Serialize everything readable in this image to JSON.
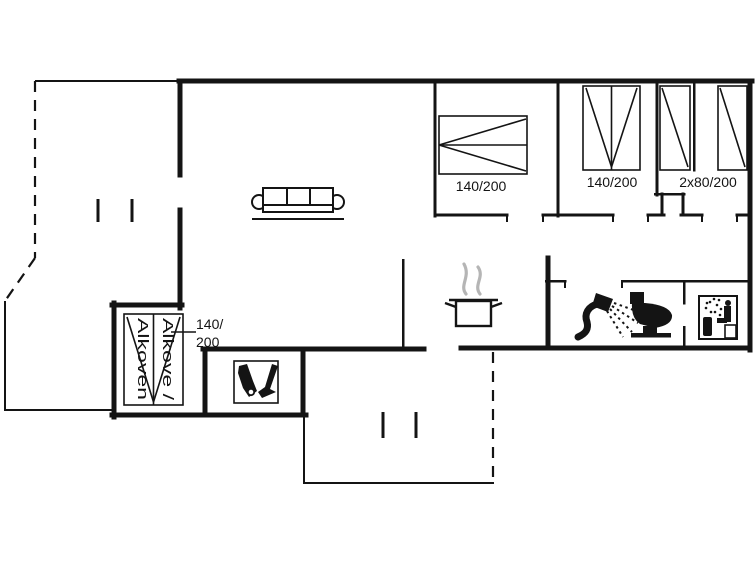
{
  "floorplan": {
    "colors": {
      "background": "#ffffff",
      "line": "#141414",
      "steam": "#b5b5b5"
    },
    "labels": {
      "bedroom1_bed_size": "140/200",
      "bedroom2_bed_size": "140/200",
      "bedroom3_bed_size": "2x80/200",
      "alcove_size_line1": "140/",
      "alcove_size_line2": "200",
      "alcove_name_line1": "Alkove /",
      "alcove_name_line2": "Alkoven"
    },
    "icons": [
      "sofa-icon",
      "cooking-pot-icon",
      "steam-icon",
      "shower-icon",
      "toilet-icon",
      "sauna-icon",
      "boot-and-brush-icon",
      "double-bed-icon",
      "single-bed-icon",
      "alcove-bed-icon",
      "terrace-bench-icon"
    ]
  }
}
